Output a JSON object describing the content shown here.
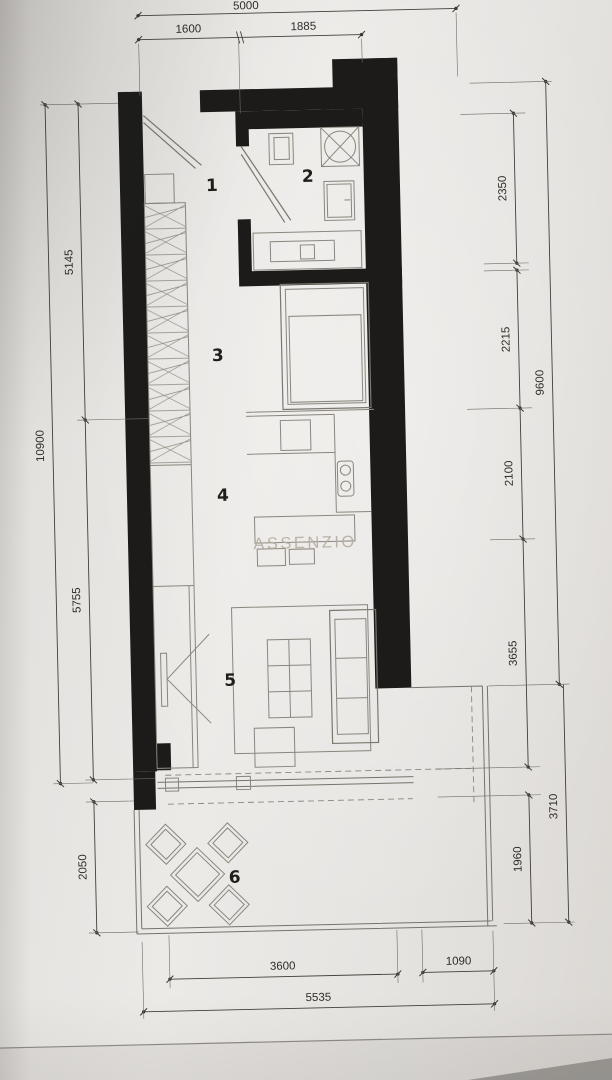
{
  "watermark": "ASSENZIO",
  "rooms": [
    "1",
    "2",
    "3",
    "4",
    "5",
    "6"
  ],
  "dimensions": {
    "top": {
      "overall": "5000",
      "left_segment": "1600",
      "right_segment": "1885"
    },
    "left": {
      "overall": "10900",
      "upper": "5145",
      "middle": "5755",
      "terrace": "2050"
    },
    "right": {
      "overall_upper": "9600",
      "overall_lower": "3710",
      "s1": "2350",
      "s2": "2215",
      "s3": "2100",
      "s4": "3655",
      "s5": "1960"
    },
    "bottom": {
      "overall": "5535",
      "main": "3600",
      "right_segment": "1090"
    }
  }
}
